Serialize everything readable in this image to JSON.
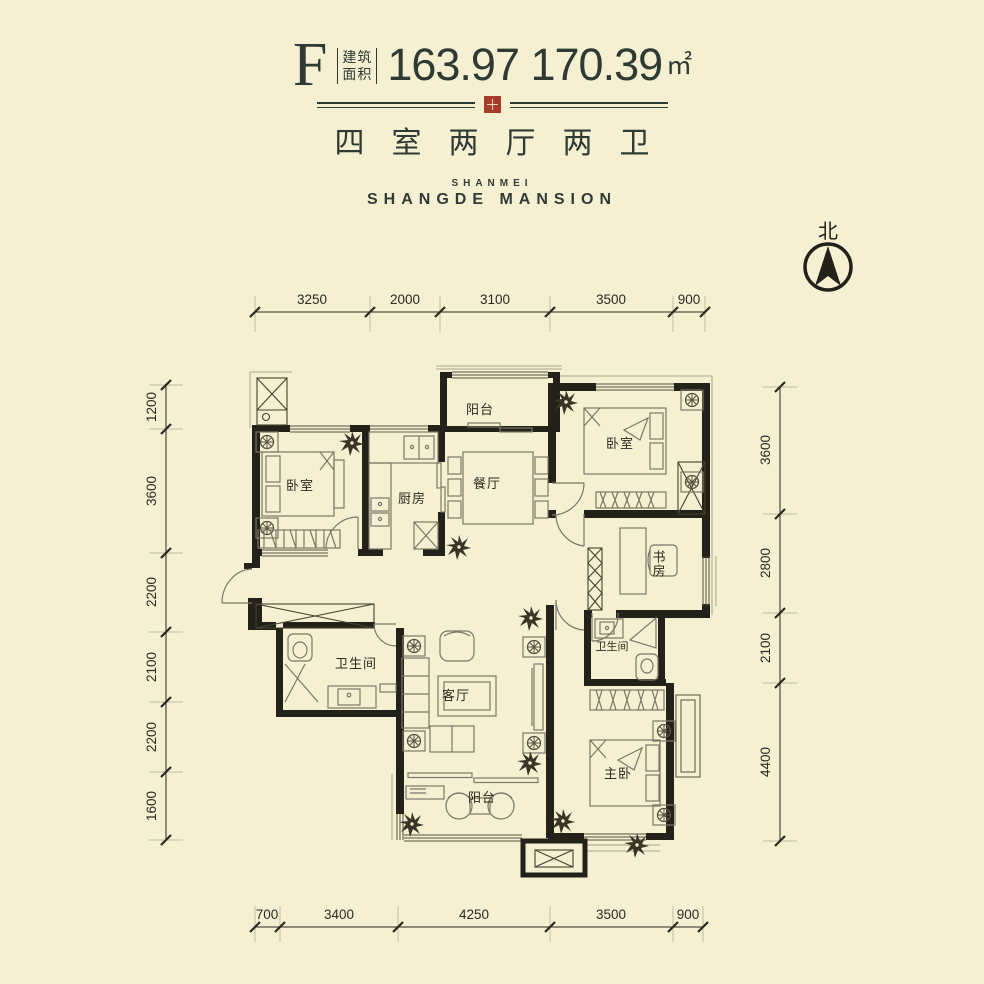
{
  "header": {
    "type_letter": "F",
    "area_label_line1": "建筑",
    "area_label_line2": "面积",
    "area_value": "163.97 170.39",
    "area_unit": "㎡",
    "subtitle": "四室两厅两卫",
    "brand_line1": "SHANMEI",
    "brand_line2": "SHANGDE MANSION"
  },
  "compass": {
    "north_label": "北"
  },
  "rooms": {
    "balcony_top": "阳台",
    "bedroom_topleft": "卧室",
    "kitchen": "厨房",
    "dining": "餐厅",
    "bedroom_topright": "卧室",
    "study": "书房",
    "bathroom_left": "卫生间",
    "living": "客厅",
    "bathroom_right": "卫生间",
    "master_bedroom": "主卧",
    "balcony_bottom": "阳台"
  },
  "dimensions": {
    "top": [
      "3250",
      "2000",
      "3100",
      "3500",
      "900"
    ],
    "bottom": [
      "700",
      "3400",
      "4250",
      "3500",
      "900"
    ],
    "left": [
      "1200",
      "3600",
      "2200",
      "2100",
      "2200",
      "1600"
    ],
    "right": [
      "3600",
      "2800",
      "2100",
      "4400"
    ]
  },
  "colors": {
    "background": "#f5f0d2",
    "wall": "#23221a",
    "accent_seal": "#a93b2b",
    "title_text": "#2e3a33"
  }
}
